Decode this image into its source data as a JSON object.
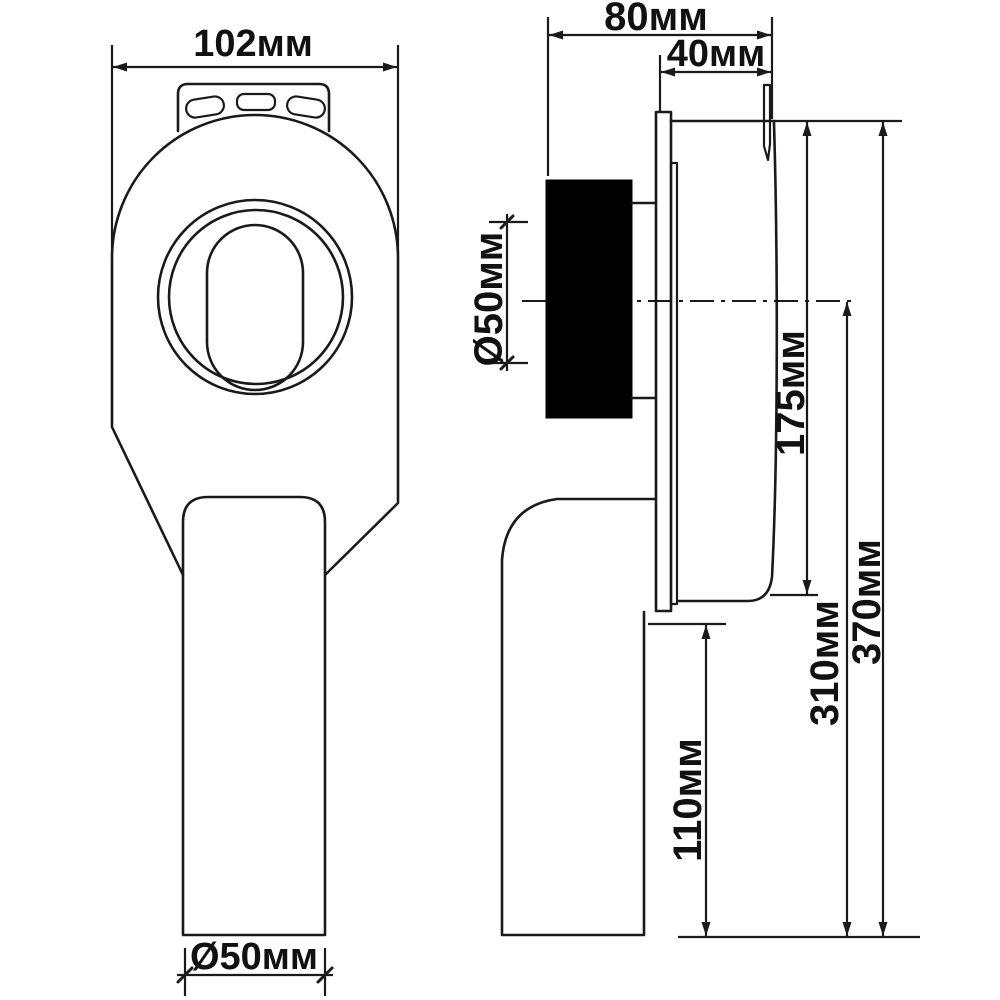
{
  "drawing": {
    "type": "technical dimensional drawing, two orthographic views of urinal siphon trap",
    "unit": "мм",
    "line_color": "#1a1a1a",
    "background": "#ffffff",
    "gasket_color": "#000000",
    "front_view": {
      "width_label": "102мм",
      "outlet_label": "Ø50мм"
    },
    "side_view": {
      "depth_label": "80мм",
      "flange_offset_label": "40мм",
      "inlet_label": "Ø50мм",
      "body_height_label": "175мм",
      "total_height_label": "370мм",
      "axis_to_bottom_label": "310мм",
      "outlet_length_label": "110мм"
    }
  }
}
